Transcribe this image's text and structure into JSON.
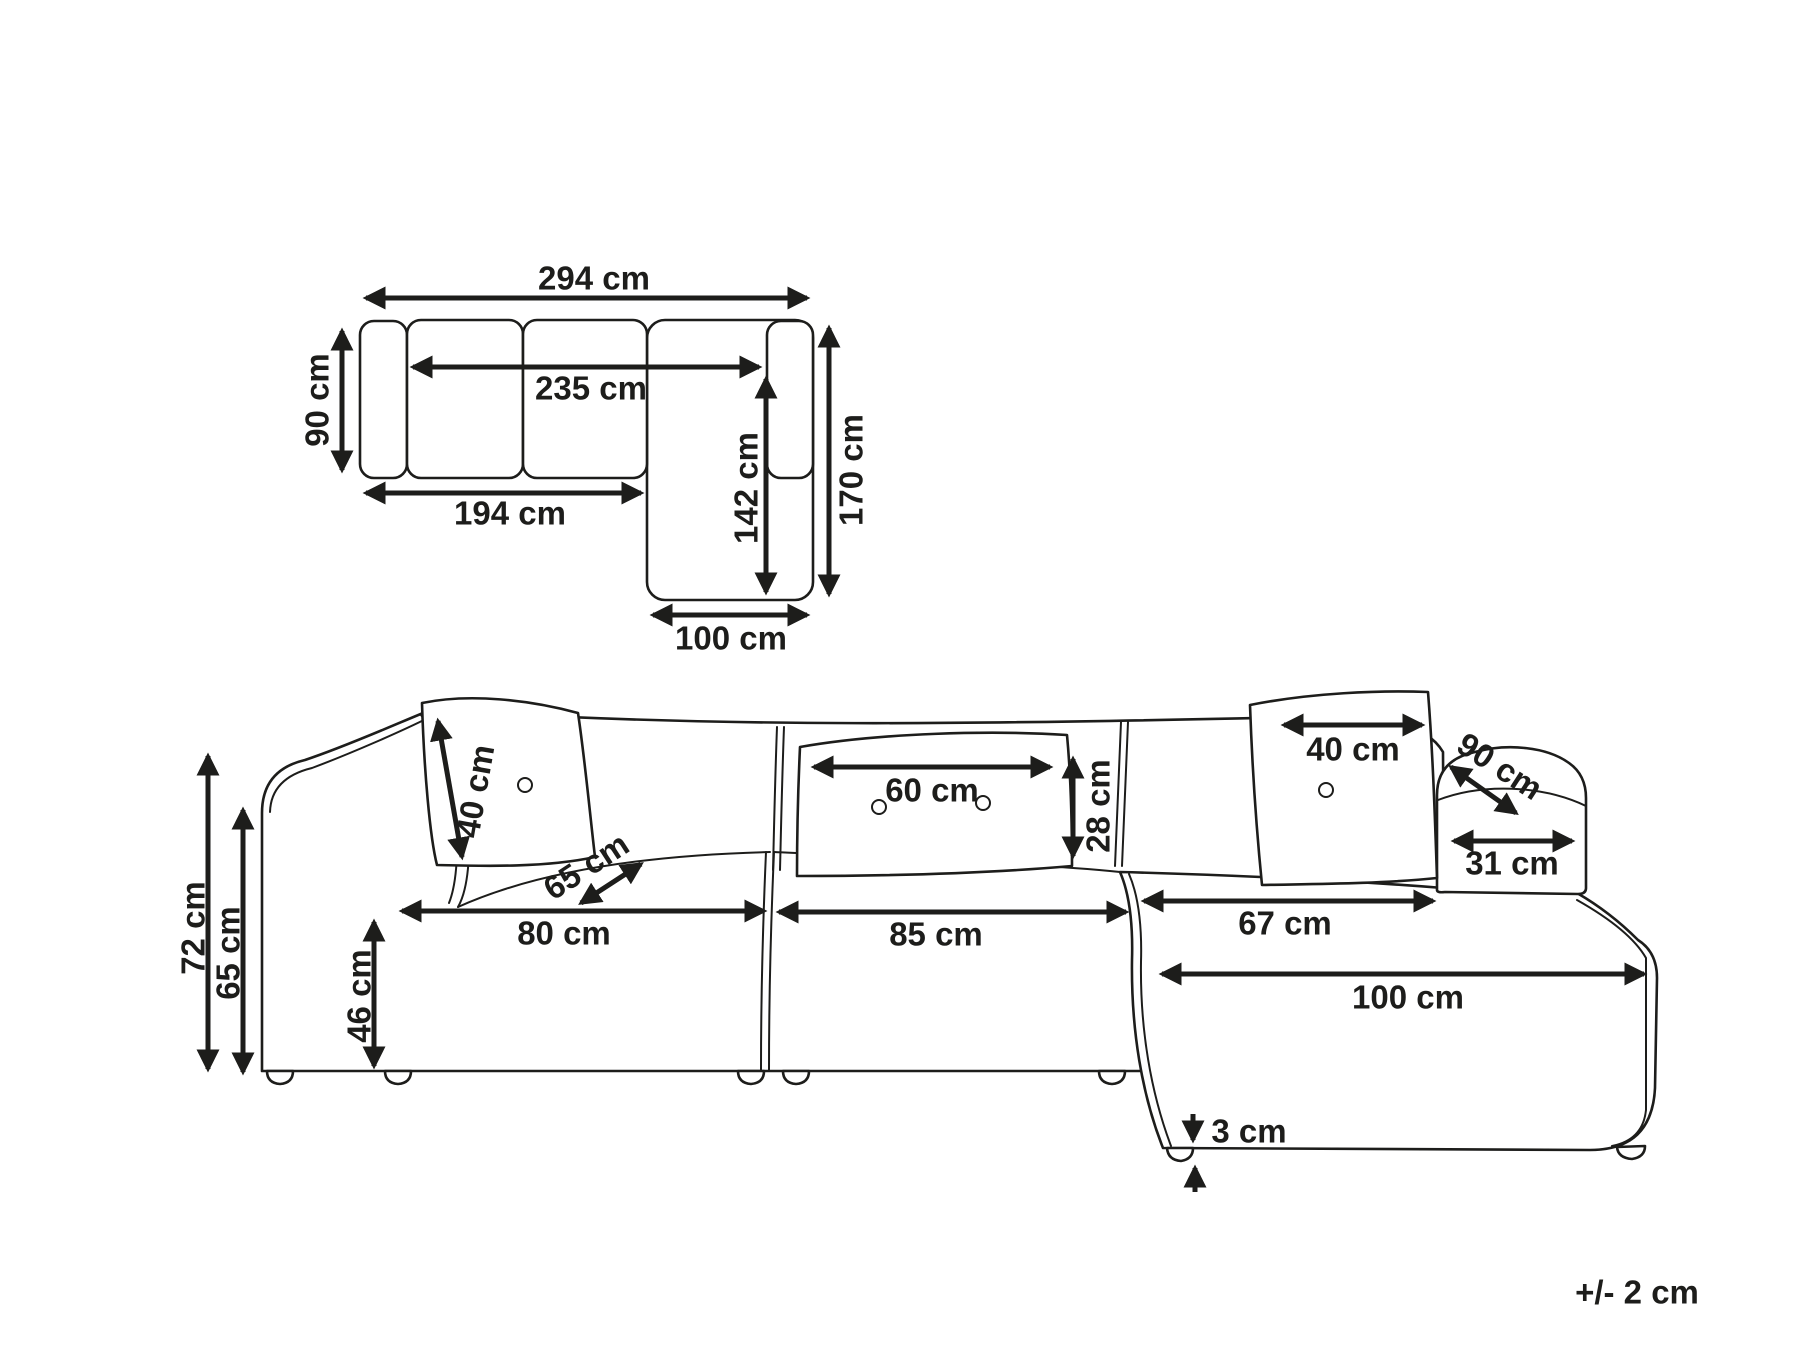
{
  "diagram": {
    "tolerance_note": "+/- 2 cm",
    "top_view": {
      "total_width": "294 cm",
      "seat_span_width": "235 cm",
      "body_depth": "90 cm",
      "left_section_length": "194 cm",
      "chaise_extension_depth": "142 cm",
      "total_depth": "170 cm",
      "chaise_width": "100 cm"
    },
    "front_view": {
      "total_height": "72 cm",
      "armrest_height": "65 cm",
      "seat_height": "46 cm",
      "left_cushion_size": "40 cm",
      "seat_depth": "65 cm",
      "left_seat_width": "80 cm",
      "lumbar_cushion_width": "60 cm",
      "lumbar_cushion_height": "28 cm",
      "middle_seat_width": "85 cm",
      "right_cushion_size": "40 cm",
      "armrest_depth": "90 cm",
      "armrest_top_width": "31 cm",
      "chaise_seat_width": "67 cm",
      "chaise_total_width": "100 cm",
      "leg_height": "3 cm"
    }
  }
}
